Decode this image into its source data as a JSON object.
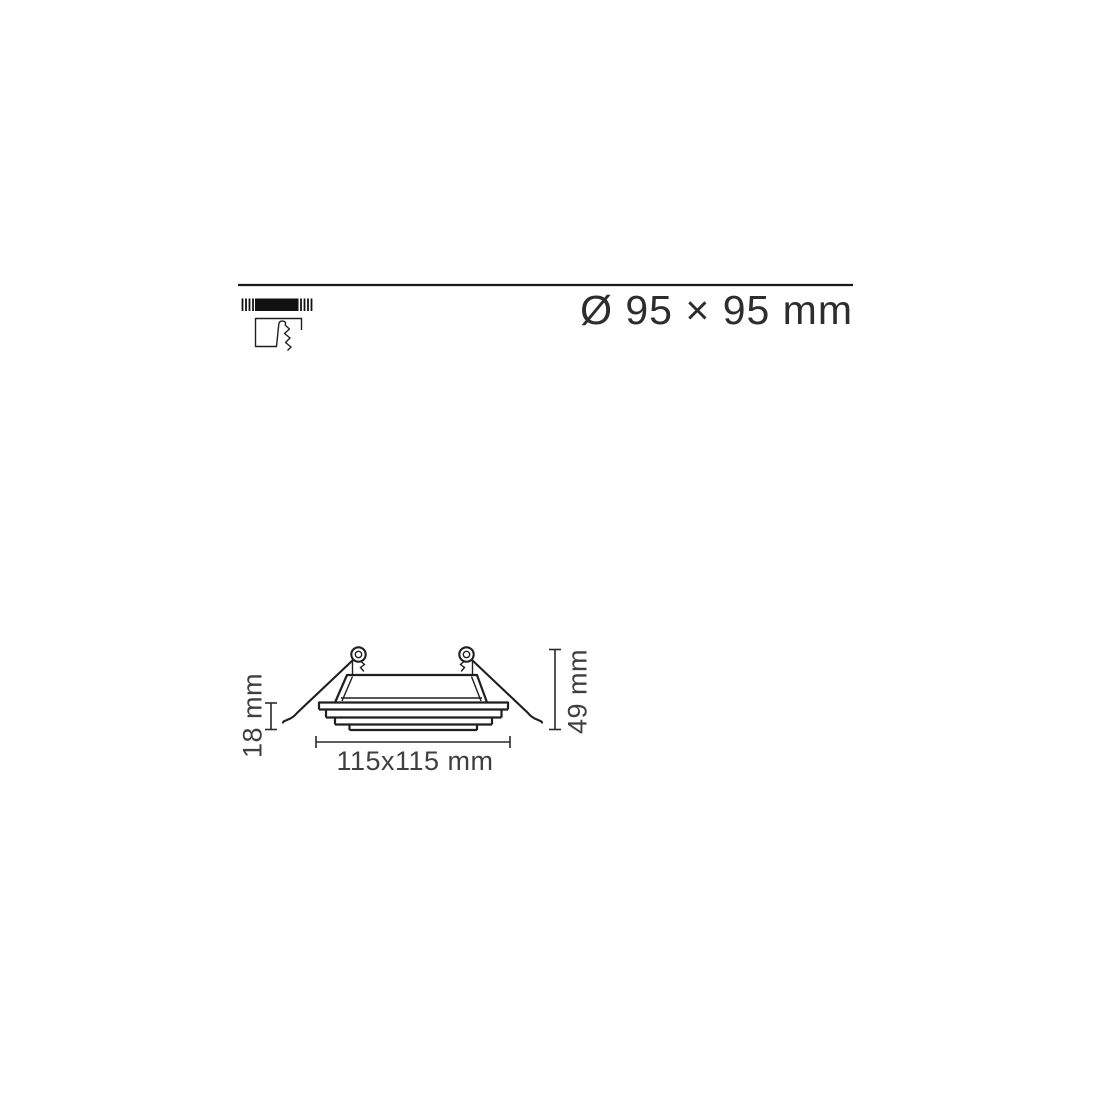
{
  "page": {
    "background": "#ffffff"
  },
  "header": {
    "cutout_size_label": "Ø 95 × 95 mm",
    "divider_color": "#1a1a1a",
    "label_color": "#2d2d2d",
    "mounting_icon": "recessed-ceiling-cutout-icon"
  },
  "drawing": {
    "line_color": "#1f1f1f",
    "dimension_text_color": "#3f3f3f",
    "labels": {
      "overall_width": "115x115 mm",
      "flange_height": "18 mm",
      "total_height": "49 mm"
    }
  }
}
